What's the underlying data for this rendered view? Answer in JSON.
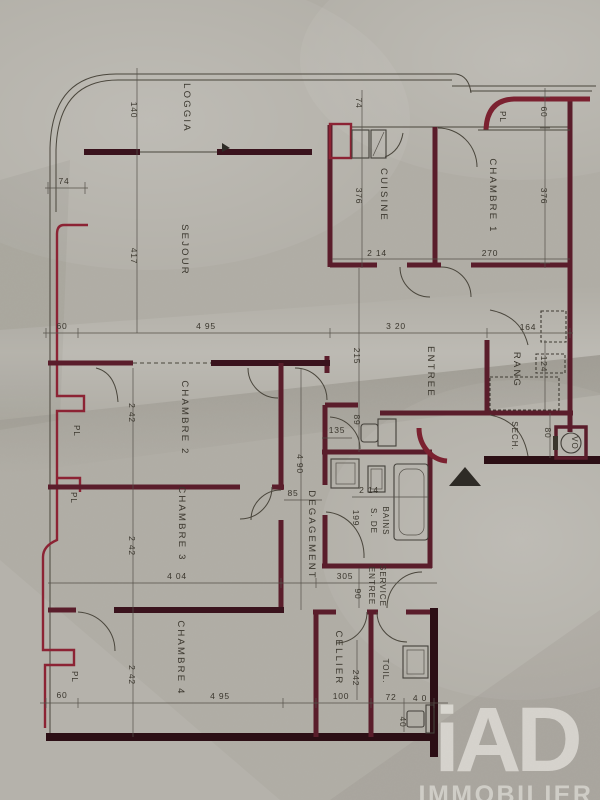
{
  "rooms": {
    "loggia": "LOGGIA",
    "sejour": "SEJOUR",
    "cuisine": "CUISINE",
    "chambre1": "CHAMBRE 1",
    "chambre2": "CHAMBRE 2",
    "chambre3": "CHAMBRE 3",
    "chambre4": "CHAMBRE 4",
    "entree": "ENTREE",
    "rang": "RANG",
    "sech": "SECH.",
    "vo": "VO",
    "pl": "PL",
    "degagement": "DEGAGEMENT",
    "bains_l1": "S. DE",
    "bains_l2": "BAINS",
    "service_l1": "ENTREE",
    "service_l2": "SERVICE",
    "cellier": "CELLIER",
    "toil": "TOIL."
  },
  "dims": {
    "loggia_depth": "140",
    "parapet_left": "74",
    "cuisine_top": "74",
    "cuisine_height": "376",
    "cuisine_width": "2 14",
    "chambre1_width": "270",
    "chambre1_height": "376",
    "pl_top_depth": "60",
    "sejour_height": "417",
    "sejour_left": "60",
    "sejour_width": "4 95",
    "entree_width": "3 20",
    "rang_width": "164",
    "entree_height": "215",
    "chambre2_height": "2 42",
    "degagement_height": "4 90",
    "degagement_width": "85",
    "wc_door": "135",
    "wc_width": "89",
    "rang_shelf": "124",
    "bains_width": "2 14",
    "bains_height": "199",
    "chambre3_height": "2 42",
    "chambre3_width": "4 04",
    "service_width": "305",
    "service_height": "90",
    "sech_width": "80",
    "chambre4_height": "2 42",
    "chambre4_width": "4 95",
    "chambre4_left": "60",
    "cellier_width": "100",
    "cellier_height": "242",
    "toil_width": "72",
    "toil_depth": "4 0",
    "toil_inner": "40"
  },
  "logo": {
    "brand": "iAD",
    "subtitle": "IMMOBILIER"
  },
  "colors": {
    "wall": "#5a1d2b",
    "wall_dark": "#2c0f15",
    "accent_red": "#8c2334",
    "line": "#4a463c",
    "paper": "#b0ada5"
  }
}
